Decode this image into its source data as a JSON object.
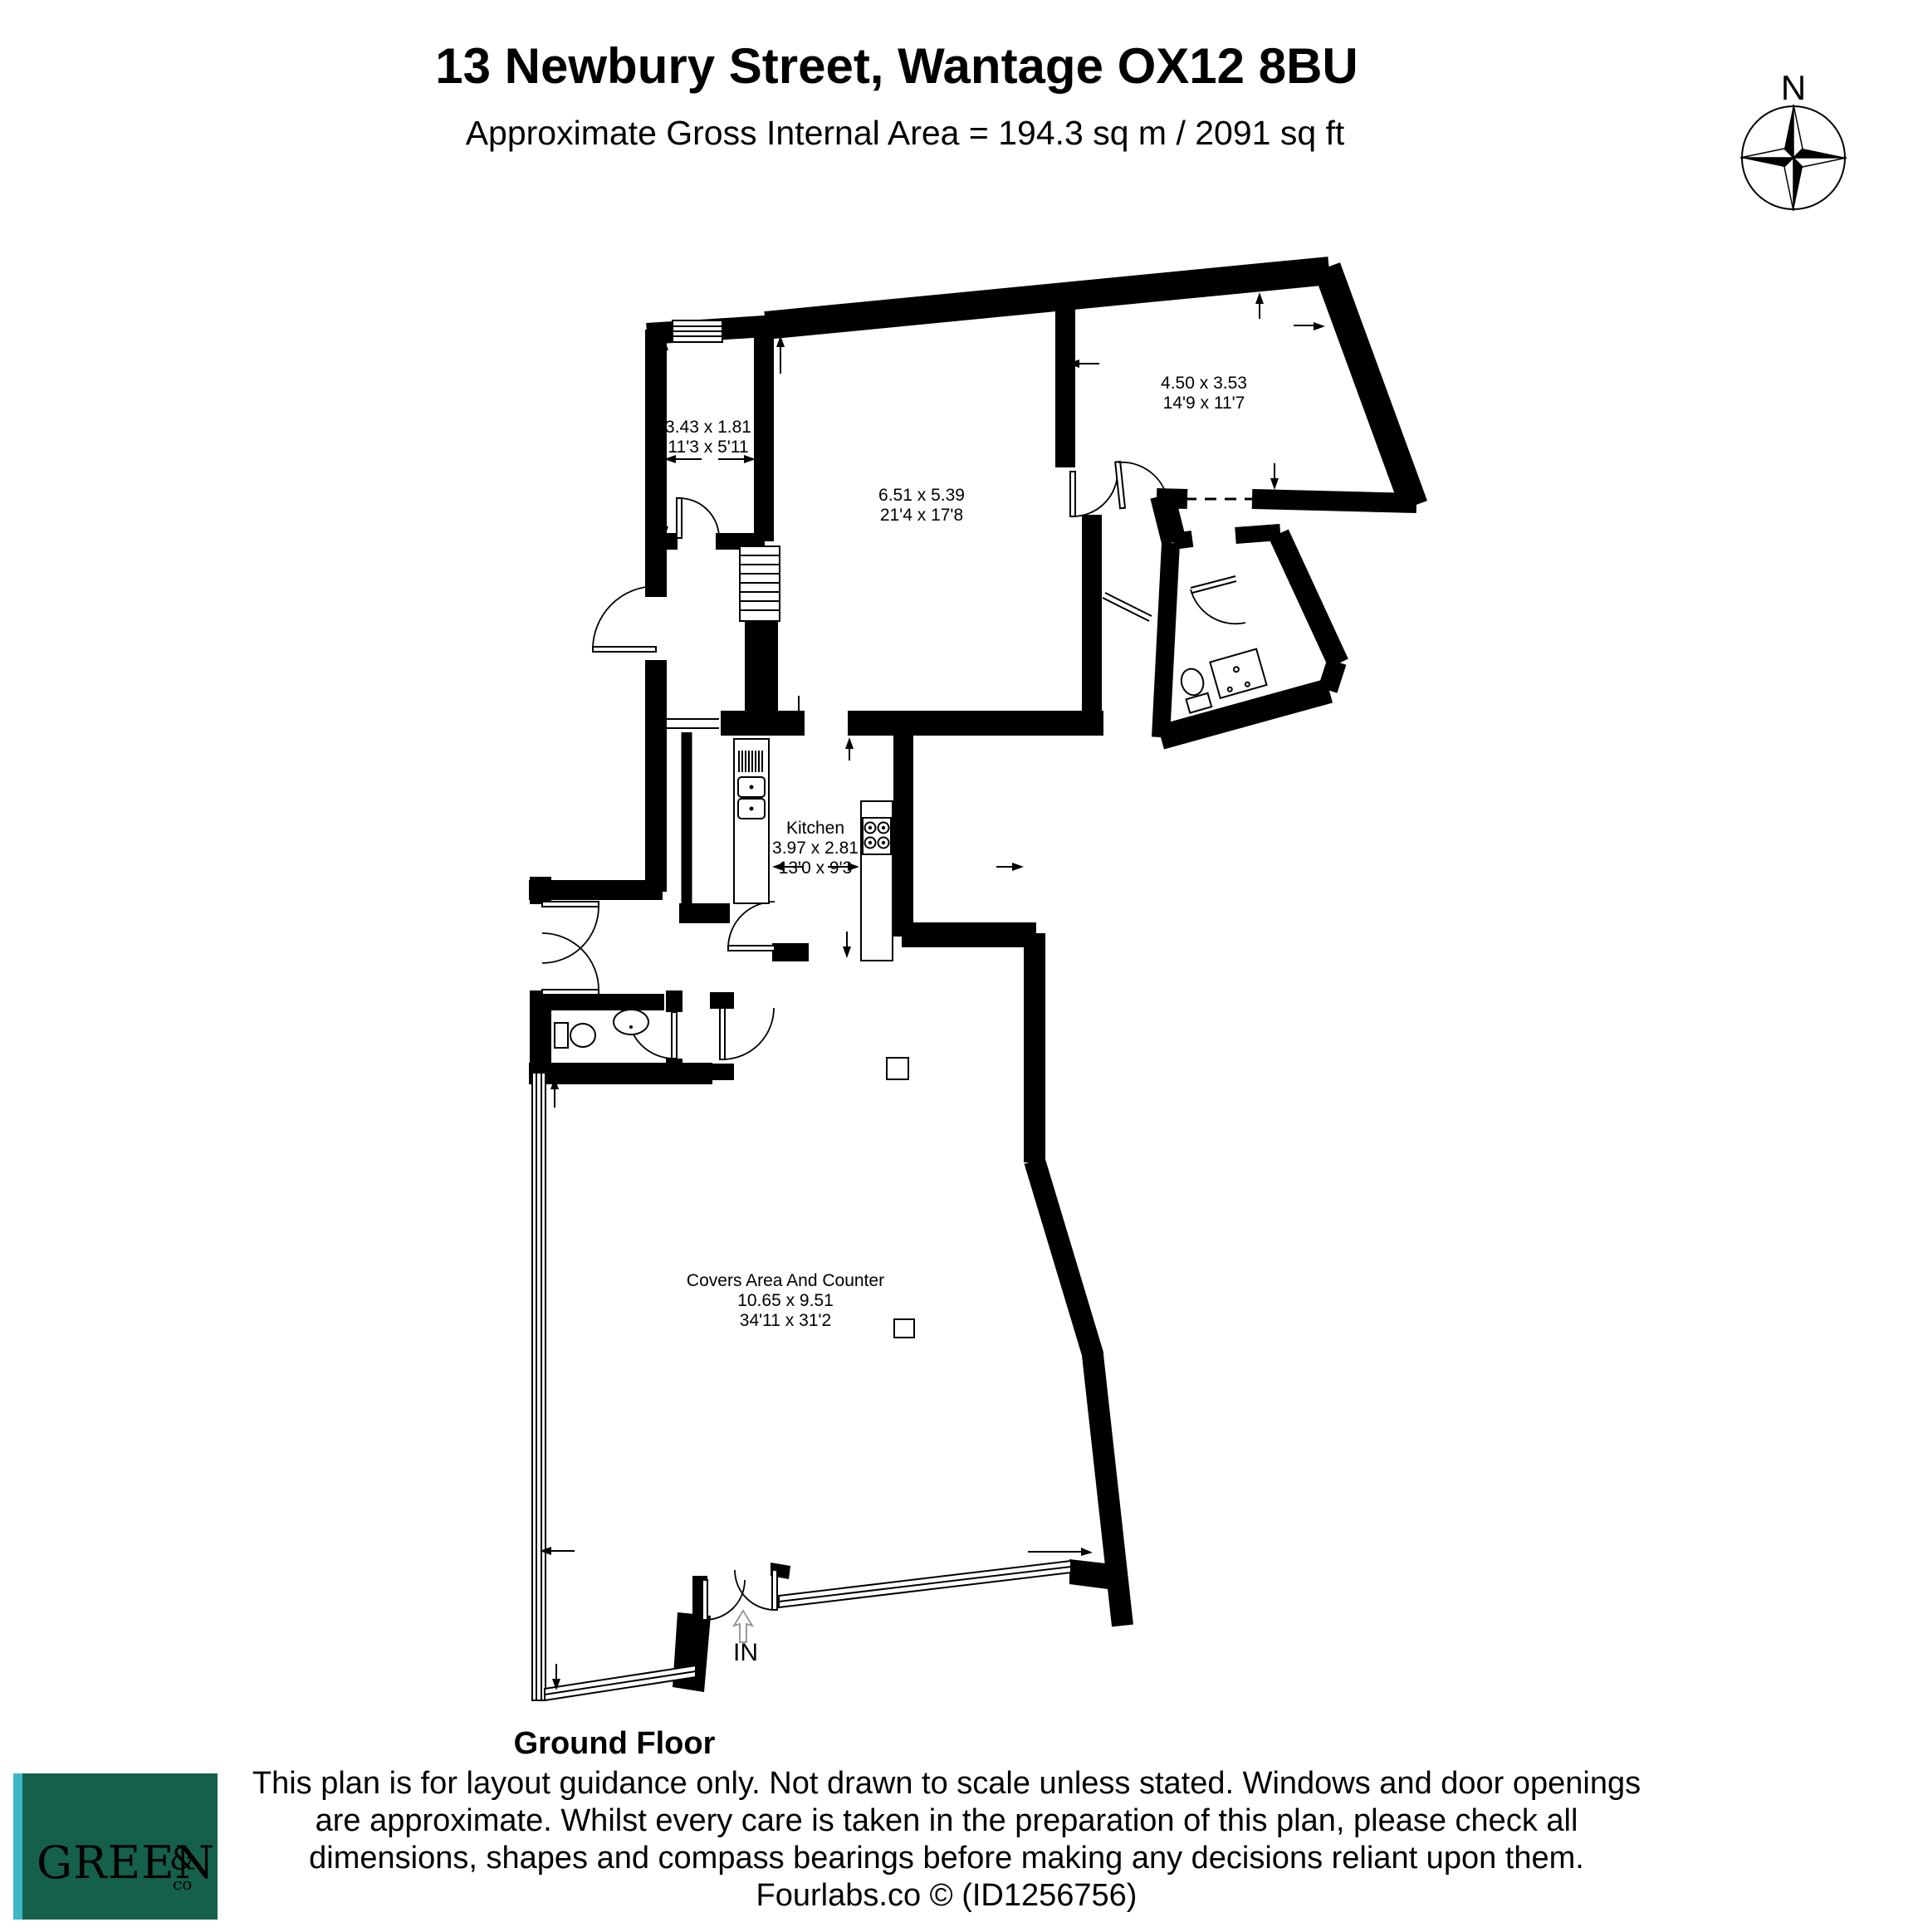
{
  "header": {
    "title": "13 Newbury Street, Wantage OX12 8BU",
    "subtitle": "Approximate Gross Internal Area = 194.3 sq m / 2091 sq ft",
    "compass_label": "N"
  },
  "rooms": [
    {
      "id": "store-room",
      "name": "",
      "dims_m": "3.43 x 1.81",
      "dims_ft": "11'3 x 5'11"
    },
    {
      "id": "reception-room",
      "name": "",
      "dims_m": "6.51 x 5.39",
      "dims_ft": "21'4 x 17'8"
    },
    {
      "id": "top-right-room",
      "name": "",
      "dims_m": "4.50 x 3.53",
      "dims_ft": "14'9 x 11'7"
    },
    {
      "id": "kitchen",
      "name": "Kitchen",
      "dims_m": "3.97 x 2.81",
      "dims_ft": "13'0 x 9'3"
    },
    {
      "id": "covers-area",
      "name": "Covers Area And Counter",
      "dims_m": "10.65 x 9.51",
      "dims_ft": "34'11 x 31'2"
    }
  ],
  "entrance": {
    "label": "IN"
  },
  "footer": {
    "floor_label": "Ground Floor",
    "disclaimer_lines": [
      "This plan is for layout guidance only. Not drawn to scale unless stated. Windows and door openings",
      "are approximate. Whilst every care is taken in the preparation of this plan, please check all",
      "dimensions, shapes and compass bearings before making any decisions reliant upon them."
    ],
    "credit": "Fourlabs.co © (ID1256756)"
  },
  "logo": {
    "name": "GREEN",
    "amp": "&",
    "co": "co",
    "color_green": "#15604c",
    "color_teal": "#3fb6c6",
    "text_color": "#ffffff"
  },
  "colors": {
    "wall": "#000000",
    "paper": "#ffffff"
  }
}
